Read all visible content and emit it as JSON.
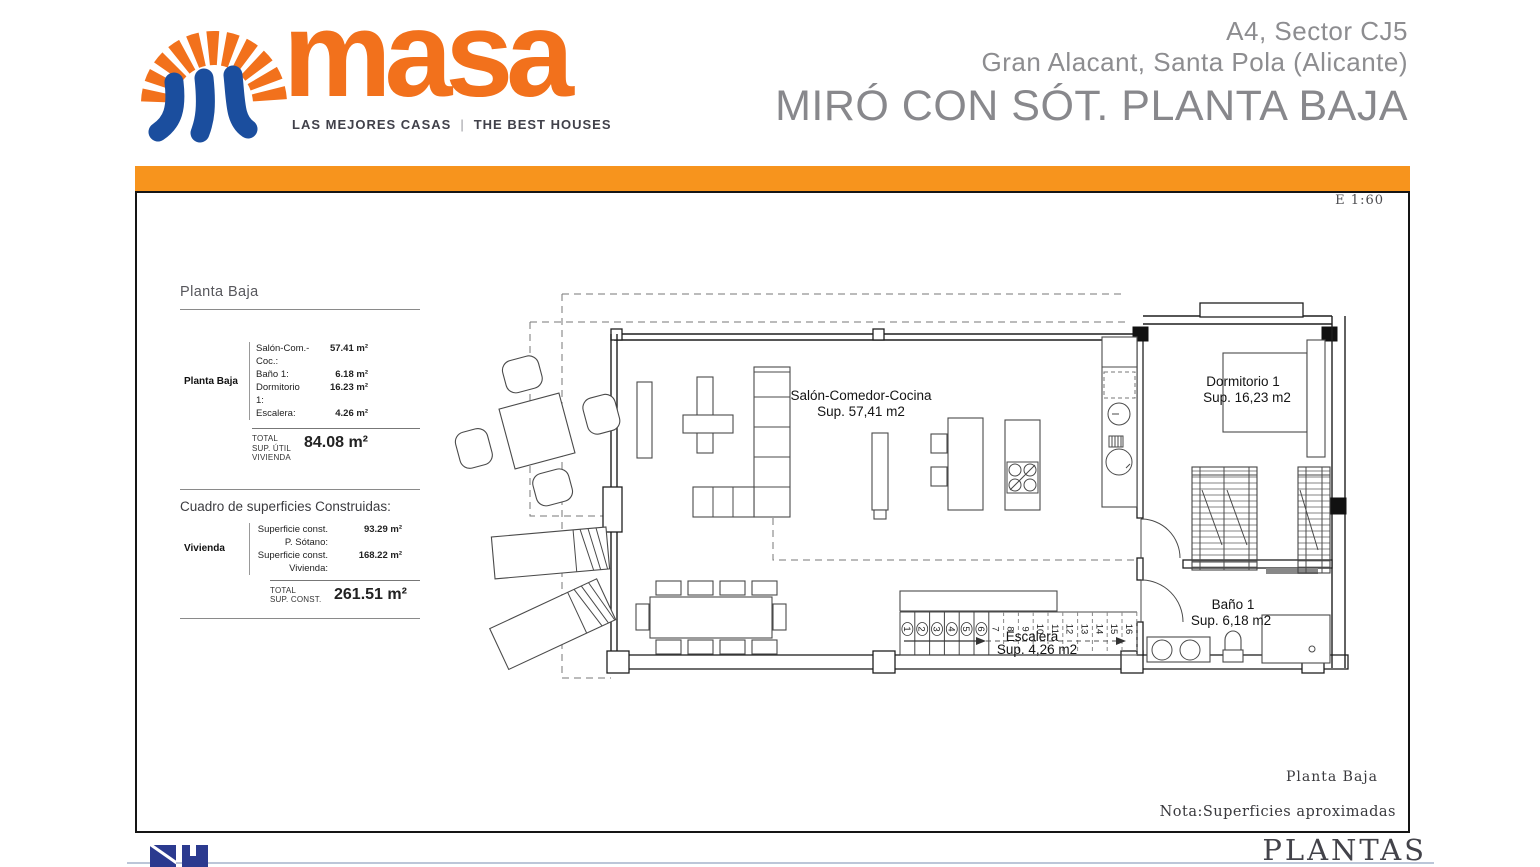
{
  "brand": {
    "wordmark": "masa",
    "tagline_left": "LAS MEJORES CASAS",
    "tagline_separator": "|",
    "tagline_right": "THE BEST HOUSES",
    "colors": {
      "orange": "#F2711C",
      "bar_orange": "#F7941D",
      "blue": "#1B4E9E"
    }
  },
  "header": {
    "line1": "A4, Sector CJ5",
    "line2": "Gran Alacant, Santa Pola (Alicante)",
    "title": "MIRÓ CON SÓT. PLANTA BAJA"
  },
  "sheet": {
    "scale_label": "E 1:60",
    "plan_caption": "Planta Baja",
    "note": "Nota:Superficies aproximadas",
    "series_title": "PLANTAS"
  },
  "useful_surfaces": {
    "title": "Planta Baja",
    "group_label": "Planta Baja",
    "rows": [
      {
        "label": "Salón-Com.-Coc.:",
        "value": "57.41 m²"
      },
      {
        "label": "Baño 1:",
        "value": "6.18 m²"
      },
      {
        "label": "Dormitorio 1:",
        "value": "16.23 m²"
      },
      {
        "label": "Escalera:",
        "value": "4.26 m²"
      }
    ],
    "total": {
      "lines": [
        "TOTAL",
        "SUP. ÚTIL",
        "VIVIENDA"
      ],
      "value": "84.08 m²"
    }
  },
  "built_surfaces": {
    "title": "Cuadro de superficies Construidas:",
    "group_label": "Vivienda",
    "rows": [
      {
        "label": "Superficie const. P. Sótano:",
        "value": "93.29 m²"
      },
      {
        "label": "Superficie const. Vivienda:",
        "value": "168.22 m²"
      }
    ],
    "total": {
      "lines": [
        "TOTAL",
        "SUP. CONST."
      ],
      "value": "261.51 m²"
    }
  },
  "plan": {
    "rooms": {
      "salon": {
        "name": "Salón-Comedor-Cocina",
        "area": "Sup. 57,41 m2"
      },
      "dormitorio": {
        "name": "Dormitorio 1",
        "area": "Sup. 16,23 m2"
      },
      "escalera": {
        "name": "Escalera",
        "area": "Sup. 4,26 m2"
      },
      "bano": {
        "name": "Baño 1",
        "area": "Sup. 6,18 m2"
      }
    },
    "stair_numbers": [
      "1",
      "2",
      "3",
      "4",
      "5",
      "6",
      "7",
      "8",
      "9",
      "10",
      "11",
      "12",
      "13",
      "14",
      "15",
      "16"
    ]
  }
}
